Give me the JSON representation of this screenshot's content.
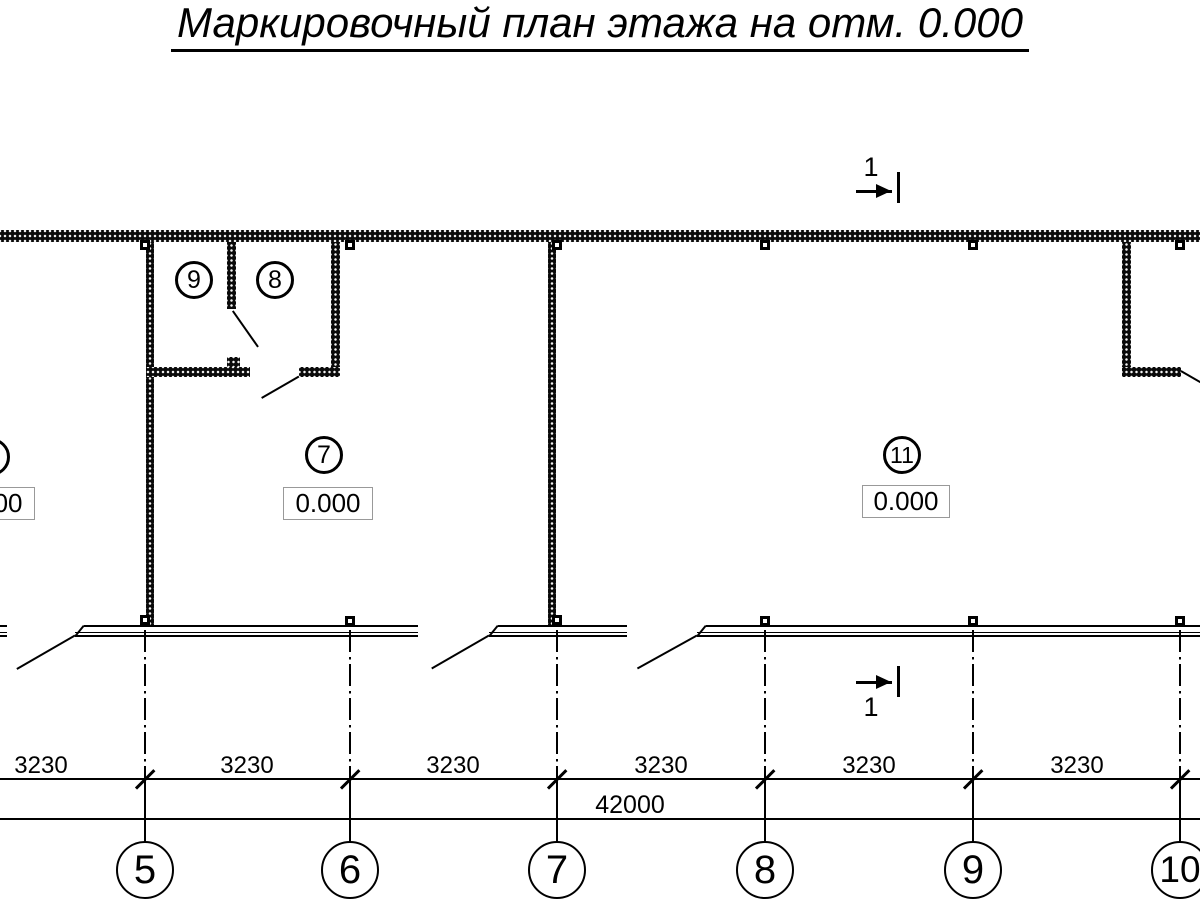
{
  "title": {
    "text": "Маркировочный план этажа на отм. 0.000"
  },
  "section_mark": {
    "top_label": "1",
    "bottom_label": "1"
  },
  "rooms": {
    "room9": {
      "number": "9"
    },
    "room8": {
      "number": "8"
    },
    "room7": {
      "number": "7",
      "elevation": "0.000"
    },
    "room11": {
      "number": "11",
      "elevation": "0.000"
    },
    "room_left": {
      "elevation": "0.000"
    }
  },
  "dimensions": {
    "segments": [
      "3230",
      "3230",
      "3230",
      "3230",
      "3230",
      "3230"
    ],
    "overall": "42000"
  },
  "axes": {
    "bubbles": [
      "5",
      "6",
      "7",
      "8",
      "9",
      "10"
    ]
  }
}
